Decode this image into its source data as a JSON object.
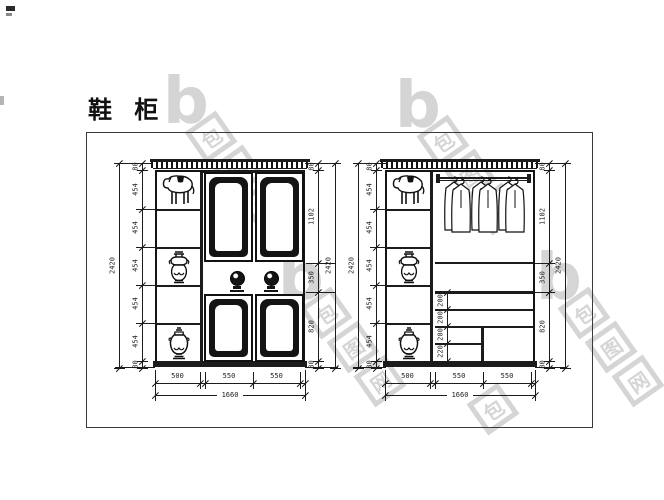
{
  "title": "鞋 柜",
  "watermark": {
    "logo_text": "b",
    "site_chars": [
      "包",
      "图",
      "网"
    ]
  },
  "colors": {
    "line": "#1c1c1c",
    "watermark": "#d5d5d5",
    "background": "#ffffff"
  },
  "left_view": {
    "height_total_left": [
      "2420"
    ],
    "height_segments_left": [
      "80",
      "454",
      "454",
      "454",
      "454",
      "454",
      "80"
    ],
    "height_segments_right": [
      "80",
      "1102",
      "350",
      "820",
      "80"
    ],
    "height_total_right": [
      "2420"
    ],
    "width_segments": [
      "500",
      "",
      "550",
      "550",
      ""
    ],
    "width_total": [
      "1660"
    ]
  },
  "right_view": {
    "height_total_left": [
      "2420"
    ],
    "height_segments_left": [
      "80",
      "454",
      "454",
      "454",
      "454",
      "454",
      "80"
    ],
    "interior_shelf_segments": [
      "200",
      "200",
      "200",
      "220"
    ],
    "height_segments_right": [
      "80",
      "1102",
      "350",
      "820",
      "80"
    ],
    "height_total_right": [
      "2420"
    ],
    "width_segments": [
      "500",
      "",
      "550",
      "550",
      ""
    ],
    "width_total": [
      "1660"
    ]
  }
}
